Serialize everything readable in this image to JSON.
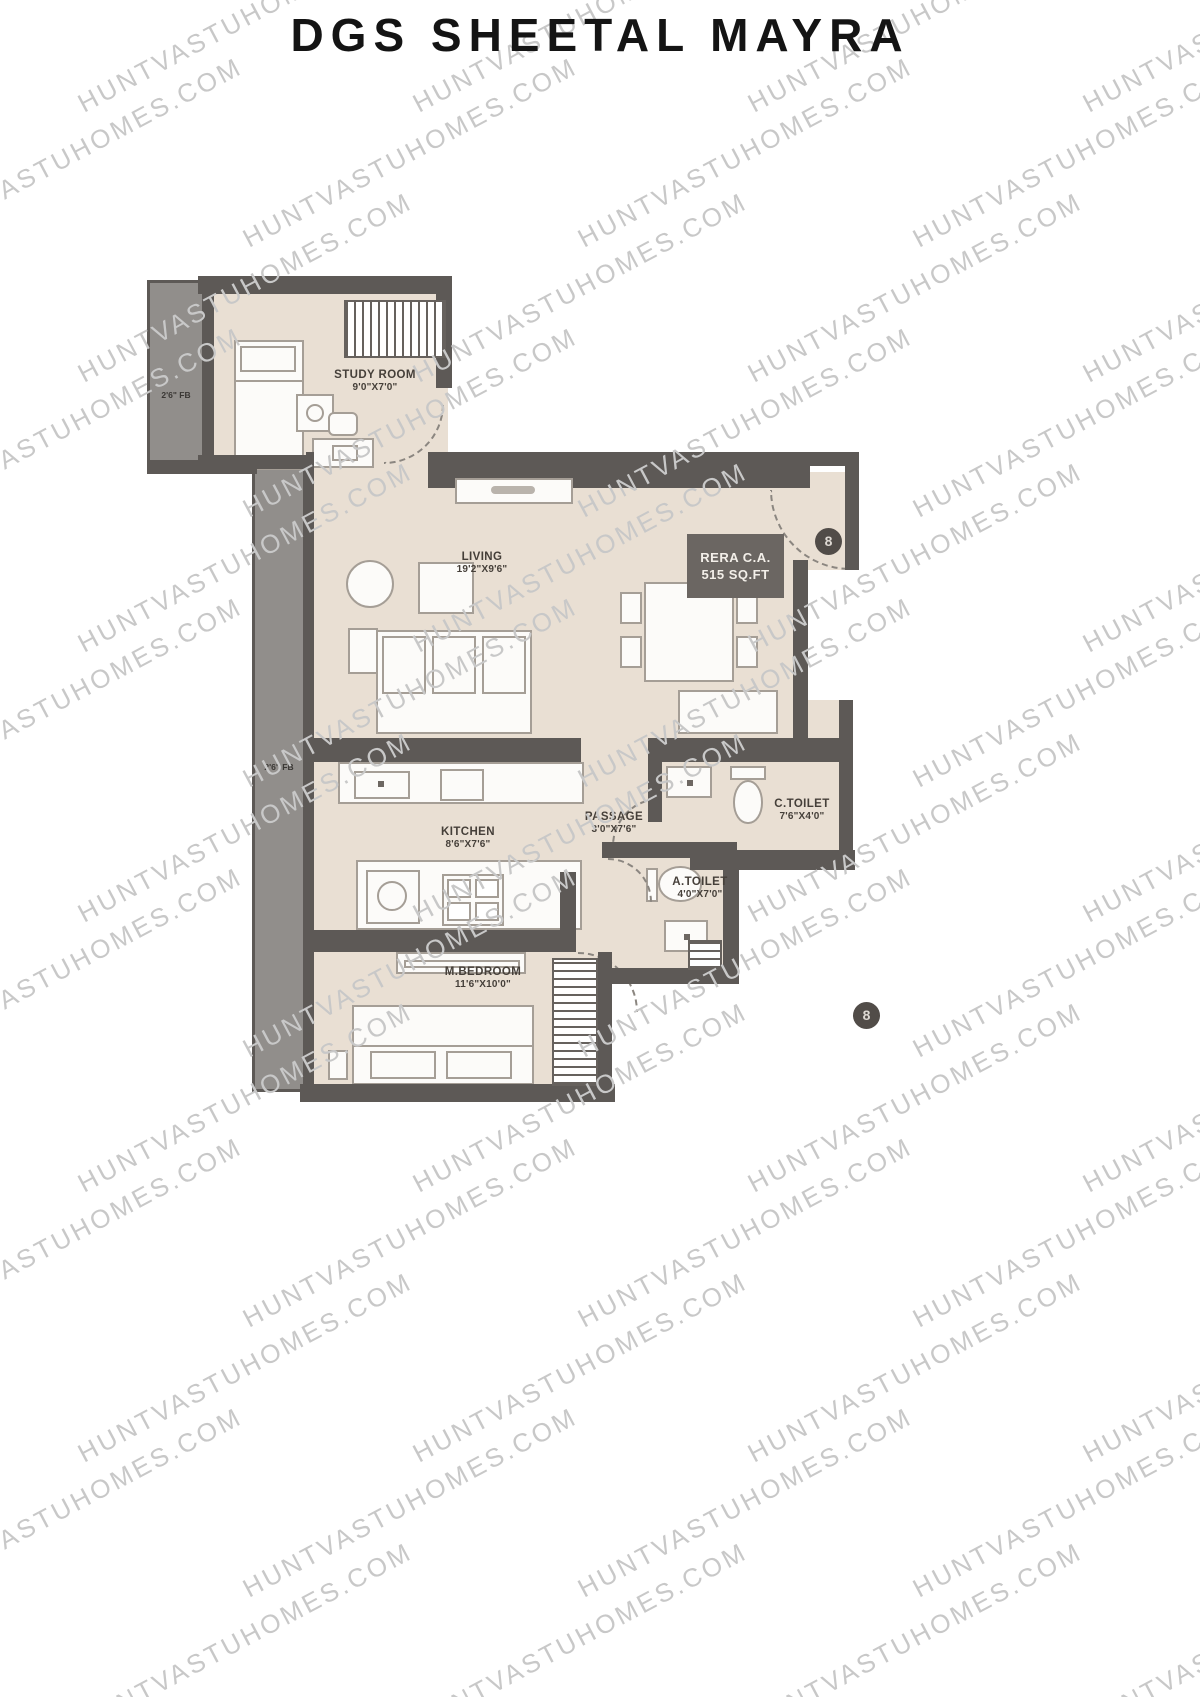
{
  "title": "DGS SHEETAL MAYRA",
  "watermark": "HUNTVASTUHOMES.COM",
  "rera": {
    "line1": "RERA C.A.",
    "line2": "515 SQ.FT"
  },
  "unit_number": "8",
  "rooms": {
    "study": {
      "name": "STUDY ROOM",
      "dims": "9'0\"X7'0\""
    },
    "living": {
      "name": "LIVING",
      "dims": "19'2\"X9'6\""
    },
    "kitchen": {
      "name": "KITCHEN",
      "dims": "8'6\"X7'6\""
    },
    "passage": {
      "name": "PASSAGE",
      "dims": "3'0\"X7'6\""
    },
    "ctoilet": {
      "name": "C.TOILET",
      "dims": "7'6\"X4'0\""
    },
    "atoilet": {
      "name": "A.TOILET",
      "dims": "4'0\"X7'0\""
    },
    "mbedroom": {
      "name": "M.BEDROOM",
      "dims": "11'6\"X10'0\""
    }
  },
  "balconies": {
    "fb1": "2'6\" FB",
    "fb2": "2'6\" FB"
  },
  "colors": {
    "wall": "#5d5956",
    "floor": "#e9dfd3",
    "balcony": "#918e8b",
    "rera_badge": "#6b6662",
    "watermark": "#c8c8c8",
    "title_text": "#141414"
  }
}
